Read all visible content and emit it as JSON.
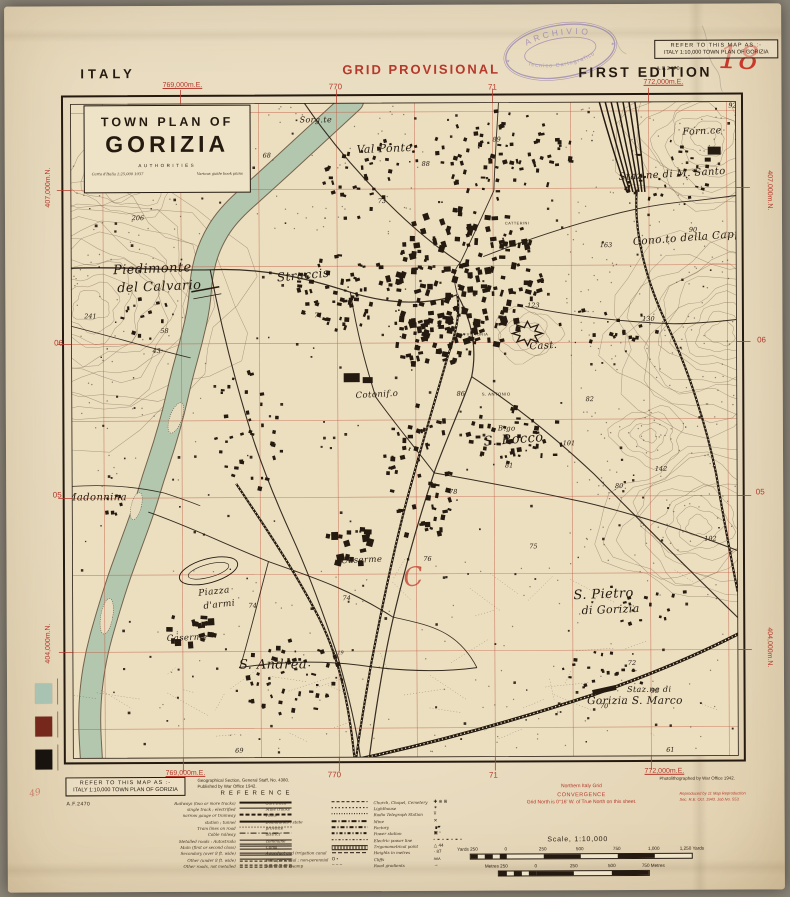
{
  "header": {
    "country": "ITALY",
    "grid_note": "GRID PROVISIONAL",
    "edition": "FIRST EDITION",
    "sheet_number": "18",
    "refer_line1": "REFER TO THIS MAP AS :-",
    "refer_line2": "ITALY 1:10,000 TOWN PLAN OF GORIZIA",
    "series_ref": "A.F.2470",
    "stamp": {
      "top": "ARCHIVIO",
      "bottom": "Tecnico Cartografico"
    },
    "pencil_mark": "49"
  },
  "title_block": {
    "line1": "TOWN PLAN OF",
    "line2": "GORIZIA",
    "line3": "AUTHORITIES",
    "source_left": "Carta d'Italia 1:25,000  1937",
    "source_right": "Various guide book plans"
  },
  "grid_labels": [
    {
      "text": "769,000m.E.",
      "cx": 178,
      "cy": 81,
      "rot": 0
    },
    {
      "text": "770",
      "cx": 331,
      "cy": 82,
      "rot": 0
    },
    {
      "text": "71",
      "cx": 488,
      "cy": 83,
      "rot": 0
    },
    {
      "text": "772,000m.E.",
      "cx": 659,
      "cy": 80,
      "rot": 0
    },
    {
      "text": "769,000m.E.",
      "cx": 178,
      "cy": 769,
      "rot": 0
    },
    {
      "text": "770",
      "cx": 327,
      "cy": 770,
      "rot": 0
    },
    {
      "text": "71",
      "cx": 486,
      "cy": 771,
      "rot": 0
    },
    {
      "text": "772,000m.E.",
      "cx": 657,
      "cy": 769,
      "rot": 0
    },
    {
      "text": "407,000m.N.",
      "cx": 44,
      "cy": 182,
      "rot": -90
    },
    {
      "text": "06",
      "cx": 53,
      "cy": 337,
      "rot": 0
    },
    {
      "text": "05",
      "cx": 51,
      "cy": 489,
      "rot": 0
    },
    {
      "text": "404,000m.N.",
      "cx": 42,
      "cy": 638,
      "rot": -90
    },
    {
      "text": "407,000m.N.",
      "cx": 764,
      "cy": 188,
      "rot": 90
    },
    {
      "text": "06",
      "cx": 756,
      "cy": 337,
      "rot": 0
    },
    {
      "text": "05",
      "cx": 754,
      "cy": 489,
      "rot": 0
    },
    {
      "text": "404,000m.N.",
      "cx": 762,
      "cy": 645,
      "rot": 90
    }
  ],
  "map": {
    "red_overprint_mark": "C",
    "places": [
      {
        "t": "Sorg.te",
        "x": 295,
        "y": 117,
        "s": 8,
        "r": 0
      },
      {
        "t": "Val Ponte",
        "x": 352,
        "y": 148,
        "s": 11,
        "r": -2
      },
      {
        "t": "Piedimonte",
        "x": 108,
        "y": 268,
        "s": 13,
        "r": -2
      },
      {
        "t": "del Calvario",
        "x": 112,
        "y": 286,
        "s": 13,
        "r": -2
      },
      {
        "t": "Straccis",
        "x": 272,
        "y": 276,
        "s": 12,
        "r": -5
      },
      {
        "t": "Cotonif.o",
        "x": 350,
        "y": 393,
        "s": 8.5,
        "r": -3
      },
      {
        "t": "Madonnina",
        "x": 60,
        "y": 494,
        "s": 10,
        "r": 0
      },
      {
        "t": "Piazza",
        "x": 192,
        "y": 590,
        "s": 9,
        "r": -6
      },
      {
        "t": "d'armi",
        "x": 197,
        "y": 603,
        "s": 9,
        "r": -6
      },
      {
        "t": "Caserme",
        "x": 160,
        "y": 635,
        "s": 8.5,
        "r": -2
      },
      {
        "t": "S. Andrea",
        "x": 232,
        "y": 663,
        "s": 13,
        "r": 0
      },
      {
        "t": "Caserme",
        "x": 335,
        "y": 558,
        "s": 8.5,
        "r": -2
      },
      {
        "t": "B.go",
        "x": 492,
        "y": 426,
        "s": 7,
        "r": 0
      },
      {
        "t": "S. Rocco",
        "x": 478,
        "y": 441,
        "s": 13,
        "r": -4
      },
      {
        "t": "S. ANTONIO",
        "x": 476,
        "y": 391,
        "s": 4.2,
        "r": 0,
        "f": "sans"
      },
      {
        "t": "Cast.",
        "x": 524,
        "y": 345,
        "s": 10,
        "r": -3
      },
      {
        "t": "P.ZA VITTORIA",
        "x": 450,
        "y": 331,
        "s": 3.8,
        "r": 0,
        "f": "sans"
      },
      {
        "t": "CATTERINI",
        "x": 500,
        "y": 220,
        "s": 3.8,
        "r": 0,
        "f": "sans"
      },
      {
        "t": "S. Pietro",
        "x": 567,
        "y": 595,
        "s": 13,
        "r": -2
      },
      {
        "t": "di Gorizia",
        "x": 575,
        "y": 610,
        "s": 11,
        "r": -2
      },
      {
        "t": "Staz.ne di",
        "x": 620,
        "y": 688,
        "s": 8,
        "r": 0
      },
      {
        "t": "Gorizia S. Marco",
        "x": 580,
        "y": 700,
        "s": 10.5,
        "r": 0
      },
      {
        "t": "Staz.ne di M. Santo",
        "x": 614,
        "y": 176,
        "s": 10,
        "r": -3
      },
      {
        "t": "Forn.ce",
        "x": 678,
        "y": 131,
        "s": 9.5,
        "r": -2
      },
      {
        "t": "Cono.to della Cappella",
        "x": 628,
        "y": 241,
        "s": 10.5,
        "r": -4
      }
    ],
    "spot_heights": [
      {
        "t": "92",
        "x": 728,
        "y": 104
      },
      {
        "t": "90",
        "x": 688,
        "y": 228
      },
      {
        "t": "88",
        "x": 421,
        "y": 161
      },
      {
        "t": "89",
        "x": 492,
        "y": 137
      },
      {
        "t": "73",
        "x": 377,
        "y": 198
      },
      {
        "t": "206",
        "x": 133,
        "y": 214
      },
      {
        "t": "241",
        "x": 85,
        "y": 312
      },
      {
        "t": "163",
        "x": 601,
        "y": 243
      },
      {
        "t": "68",
        "x": 262,
        "y": 152
      },
      {
        "t": "58",
        "x": 159,
        "y": 327
      },
      {
        "t": "43",
        "x": 151,
        "y": 347
      },
      {
        "t": "71",
        "x": 313,
        "y": 312
      },
      {
        "t": "123",
        "x": 528,
        "y": 303
      },
      {
        "t": "130",
        "x": 643,
        "y": 317
      },
      {
        "t": "86",
        "x": 455,
        "y": 391
      },
      {
        "t": "82",
        "x": 584,
        "y": 397
      },
      {
        "t": "101",
        "x": 563,
        "y": 441
      },
      {
        "t": "81",
        "x": 503,
        "y": 463
      },
      {
        "t": "78",
        "x": 447,
        "y": 489
      },
      {
        "t": "80",
        "x": 613,
        "y": 484
      },
      {
        "t": "142",
        "x": 655,
        "y": 467
      },
      {
        "t": "102",
        "x": 704,
        "y": 537
      },
      {
        "t": "76",
        "x": 421,
        "y": 556
      },
      {
        "t": "75",
        "x": 527,
        "y": 544
      },
      {
        "t": "74",
        "x": 246,
        "y": 602
      },
      {
        "t": "74",
        "x": 340,
        "y": 595
      },
      {
        "t": "72",
        "x": 625,
        "y": 661
      },
      {
        "t": "95",
        "x": 648,
        "y": 689
      },
      {
        "t": "61",
        "x": 663,
        "y": 748
      },
      {
        "t": "69",
        "x": 232,
        "y": 747
      },
      {
        "t": "70",
        "x": 597,
        "y": 704
      },
      {
        "t": "K.19",
        "x": 331,
        "y": 649
      }
    ]
  },
  "footer": {
    "refer_line1": "REFER TO THIS MAP AS :-",
    "refer_line2": "ITALY 1:10,000 TOWN PLAN OF GORIZIA",
    "series_ref": "A.F.2470",
    "publisher_line1": "Geographical Section, General Staff, No. 4380.",
    "publisher_line2": "Published by War Office 1942.",
    "reference_title": "REFERENCE",
    "legend_col1": [
      {
        "label": "Railways (two or more tracks)",
        "sym": "rail2"
      },
      {
        "label": "single track ; electrified",
        "sym": "rail1"
      },
      {
        "label": "narrow gauge or tramway",
        "sym": "railn"
      },
      {
        "label": "station ; tunnel",
        "sym": "railst"
      },
      {
        "label": "Tram lines on road",
        "sym": "tram"
      },
      {
        "label": "Cable railway",
        "sym": "cable"
      },
      {
        "label": "Metalled roads :  Autostrada",
        "sym": "roadA"
      },
      {
        "label": "Main (first or second class)",
        "sym": "roadM"
      },
      {
        "label": "Secondary (over 8 ft. wide)",
        "sym": "roadS"
      },
      {
        "label": "Other (under 8 ft. wide)",
        "sym": "roadO"
      },
      {
        "label": "Other roads, not metalled",
        "sym": "roadU"
      }
    ],
    "legend_col2": [
      {
        "label": "Cart track",
        "sym": "cart"
      },
      {
        "label": "Mule tracks",
        "sym": "mule"
      },
      {
        "label": "Paths",
        "sym": "path"
      },
      {
        "label": "Boundaries :  state",
        "sym": "bstate"
      },
      {
        "label": "province",
        "sym": "bprov"
      },
      {
        "label": "district",
        "sym": "bdist"
      },
      {
        "label": "commune",
        "sym": "bcomm"
      },
      {
        "label": "Canal",
        "sym": "canal"
      },
      {
        "label": "Aqueduct and irrigation canal",
        "sym": "aqua"
      },
      {
        "label": "Well, perennial ; non-perennial",
        "sym": "well"
      },
      {
        "label": "Marsh and swamp",
        "sym": "marsh"
      }
    ],
    "legend_col3": [
      {
        "label": "Church, Chapel, Cemetery",
        "sym": "church"
      },
      {
        "label": "Lighthouse",
        "sym": "light"
      },
      {
        "label": "Radio Telegraph Station",
        "sym": "radio"
      },
      {
        "label": "Mine",
        "sym": "mine"
      },
      {
        "label": "Factory",
        "sym": "factory"
      },
      {
        "label": "Power station",
        "sym": "power"
      },
      {
        "label": "Electric power line",
        "sym": "pline"
      },
      {
        "label": "Trigonometrical point",
        "sym": "trig"
      },
      {
        "label": "Heights in metres",
        "sym": "height"
      },
      {
        "label": "Cliffs",
        "sym": "cliff"
      },
      {
        "label": "Road gradients",
        "sym": "grad"
      }
    ],
    "convergence_line1": "Northern Italy Grid",
    "convergence_line2": "CONVERGENCE",
    "convergence_line3": "Grid North is 0°16' W. of True North on this sheet.",
    "photolith": "Photolithographed by War Office 1942.",
    "repro_line1": "Reproduced by 11 Map Reproduction",
    "repro_line2": "Sec. R.E.   Oct. 1943.   Job No. 553.",
    "scale_title": "Scale, 1:10,000",
    "yards_labels": [
      "Yards 250",
      "0",
      "250",
      "500",
      "750",
      "1,000",
      "1,250 Yards"
    ],
    "metres_labels": [
      "Metres 250",
      "0",
      "250",
      "500",
      "750 Metres"
    ]
  },
  "colors": {
    "paper": "#eadec2",
    "map_background": "#ecdfc0",
    "ink": "#241a10",
    "overprint_red": "#b5392b",
    "water_green": "#b3c7ae",
    "bank_brown": "#55432e",
    "contour_brown": "#6a523a",
    "stamp_purple": "#7b63ad",
    "swatches": [
      "#a9c3b2",
      "#77281c",
      "#191310"
    ]
  }
}
